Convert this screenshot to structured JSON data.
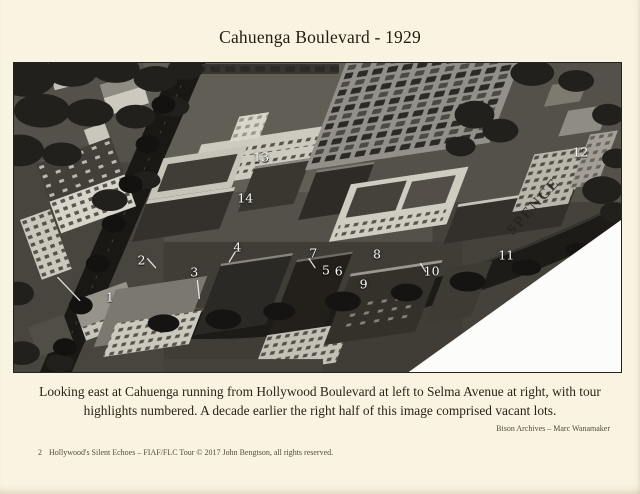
{
  "page": {
    "title": "Cahuenga Boulevard - 1929",
    "caption": "Looking east at Cahuenga running from Hollywood Boulevard at left to Selma Avenue at right, with tour highlights numbered. A decade earlier the right half of this image comprised vacant lots.",
    "credit": "Bison Archives – Marc Wanamaker",
    "footer": {
      "page_number": "2",
      "text": "Hollywood's Silent Echoes – FIAF/FLC Tour © 2017 John Bengtson, all rights reserved."
    }
  },
  "photo": {
    "description": "Black-and-white 1929 oblique aerial photograph of Cahuenga Boulevard in Hollywood with numbered tour highlights; bottom-right corner of the print is blank white",
    "watermark": {
      "text": "SPENCE",
      "rotation_deg": -48
    },
    "markers": [
      {
        "label": "1",
        "x": 15.8,
        "y": 75.6
      },
      {
        "label": "2",
        "x": 21.0,
        "y": 63.7
      },
      {
        "label": "3",
        "x": 29.7,
        "y": 67.5
      },
      {
        "label": "4",
        "x": 36.8,
        "y": 59.5
      },
      {
        "label": "5",
        "x": 51.4,
        "y": 66.9
      },
      {
        "label": "6",
        "x": 53.5,
        "y": 67.2
      },
      {
        "label": "7",
        "x": 49.3,
        "y": 61.4
      },
      {
        "label": "8",
        "x": 59.8,
        "y": 61.7
      },
      {
        "label": "9",
        "x": 57.6,
        "y": 71.4
      },
      {
        "label": "10",
        "x": 68.8,
        "y": 67.2
      },
      {
        "label": "11",
        "x": 81.1,
        "y": 62.1
      },
      {
        "label": "12",
        "x": 93.3,
        "y": 28.9
      },
      {
        "label": "13",
        "x": 40.7,
        "y": 30.5
      },
      {
        "label": "14",
        "x": 38.1,
        "y": 43.7
      }
    ]
  },
  "colors": {
    "page_bg": "#f9f4e1",
    "heading_text": "#241c13",
    "body_text": "#2b2218",
    "small_text": "#55493c",
    "photo_border": "#26231e",
    "marker_text": "#fafaf7"
  }
}
